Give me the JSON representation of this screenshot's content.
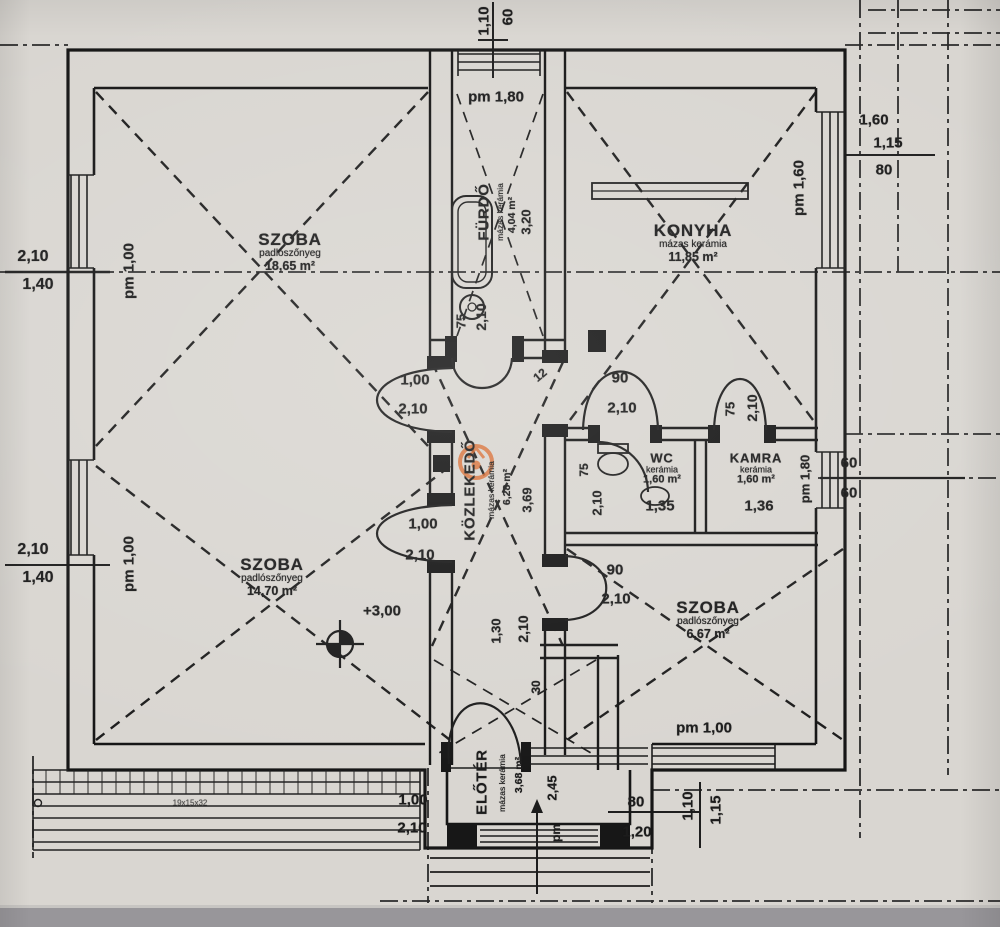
{
  "document": {
    "type": "floor-plan photo",
    "language": "hungarian"
  },
  "rooms": {
    "szoba1": {
      "name": "SZOBA",
      "floor": "padlószőnyeg",
      "area": "18,65 m²"
    },
    "konyha": {
      "name": "KONYHA",
      "floor": "mázas kerámia",
      "area": "11,85 m²"
    },
    "furdo": {
      "name": "FÜRDŐ",
      "floor": "mázas kerámia",
      "area": "4,04 m²",
      "width": "3,20"
    },
    "wc": {
      "name": "WC",
      "floor": "kerámia",
      "area": "1,60 m²",
      "width": "1,35"
    },
    "kamra": {
      "name": "KAMRA",
      "floor": "kerámia",
      "area": "1,60 m²",
      "width": "1,36"
    },
    "kozlekedo": {
      "name": "KÖZLEKEDŐ",
      "floor": "mázas kerámia",
      "area": "6,28 m²",
      "width": "3,69"
    },
    "szoba2": {
      "name": "SZOBA",
      "floor": "padlószőnyeg",
      "area": "14,70 m²"
    },
    "szoba3": {
      "name": "SZOBA",
      "floor": "padlószőnyeg",
      "area": "6,67 m²"
    },
    "eloter": {
      "name": "ELŐTÉR",
      "floor": "mázas kerámia",
      "area": "3,68 m²",
      "width": "2,45"
    }
  },
  "level_marker": {
    "value": "+3,00"
  },
  "watermark": {
    "color": "#d96a2e",
    "shape": "ring-logo"
  },
  "dims": [
    {
      "t": "1,10",
      "x": 484,
      "y": 21,
      "r": -90
    },
    {
      "t": "60",
      "x": 508,
      "y": 17,
      "r": -90
    },
    {
      "t": "pm 1,80",
      "x": 496,
      "y": 97
    },
    {
      "t": "1,60",
      "x": 874,
      "y": 120
    },
    {
      "t": "1,15",
      "x": 888,
      "y": 143
    },
    {
      "t": "80",
      "x": 884,
      "y": 170
    },
    {
      "t": "pm 1,60",
      "x": 799,
      "y": 188,
      "r": -90
    },
    {
      "t": "2,10",
      "x": 33,
      "y": 257,
      "s": 16
    },
    {
      "t": "1,40",
      "x": 38,
      "y": 285,
      "s": 16
    },
    {
      "t": "pm 1,00",
      "x": 129,
      "y": 271,
      "r": -90
    },
    {
      "t": "75",
      "x": 461,
      "y": 321,
      "r": -90,
      "s": 13
    },
    {
      "t": "2,10",
      "x": 481,
      "y": 317,
      "r": -90,
      "s": 14
    },
    {
      "t": "1,00",
      "x": 415,
      "y": 380
    },
    {
      "t": "2,10",
      "x": 413,
      "y": 409
    },
    {
      "t": "12",
      "x": 540,
      "y": 375,
      "r": -40,
      "s": 12
    },
    {
      "t": "90",
      "x": 620,
      "y": 378
    },
    {
      "t": "2,10",
      "x": 622,
      "y": 408
    },
    {
      "t": "75",
      "x": 730,
      "y": 409,
      "r": -90,
      "s": 13
    },
    {
      "t": "2,10",
      "x": 752,
      "y": 408,
      "r": -90,
      "s": 14
    },
    {
      "t": "pm 1,80",
      "x": 805,
      "y": 479,
      "r": -90,
      "s": 13
    },
    {
      "t": "60",
      "x": 849,
      "y": 463
    },
    {
      "t": "60",
      "x": 849,
      "y": 493
    },
    {
      "t": "75",
      "x": 584,
      "y": 470,
      "r": -90,
      "s": 12
    },
    {
      "t": "2,10",
      "x": 597,
      "y": 503,
      "r": -90,
      "s": 13
    },
    {
      "t": "1,35",
      "x": 660,
      "y": 506
    },
    {
      "t": "1,36",
      "x": 759,
      "y": 506
    },
    {
      "t": "2,10",
      "x": 33,
      "y": 550,
      "s": 16
    },
    {
      "t": "1,40",
      "x": 38,
      "y": 578,
      "s": 16
    },
    {
      "t": "pm 1,00",
      "x": 129,
      "y": 564,
      "r": -90
    },
    {
      "t": "1,00",
      "x": 423,
      "y": 524
    },
    {
      "t": "2,10",
      "x": 420,
      "y": 555
    },
    {
      "t": "90",
      "x": 615,
      "y": 570
    },
    {
      "t": "2,10",
      "x": 616,
      "y": 599
    },
    {
      "t": "1,30",
      "x": 496,
      "y": 631,
      "r": -90,
      "s": 13
    },
    {
      "t": "2,10",
      "x": 523,
      "y": 629,
      "r": -90,
      "s": 14
    },
    {
      "t": "30",
      "x": 536,
      "y": 687,
      "r": -90,
      "s": 12
    },
    {
      "t": "pm 1,00",
      "x": 704,
      "y": 728
    },
    {
      "t": "1,10",
      "x": 688,
      "y": 806,
      "r": -90
    },
    {
      "t": "1,15",
      "x": 716,
      "y": 810,
      "r": -90
    },
    {
      "t": "80",
      "x": 636,
      "y": 802
    },
    {
      "t": "1,20",
      "x": 637,
      "y": 832
    },
    {
      "t": "1,00",
      "x": 413,
      "y": 800
    },
    {
      "t": "2,10",
      "x": 412,
      "y": 828
    },
    {
      "t": "pm",
      "x": 556,
      "y": 833,
      "r": -90,
      "s": 12
    },
    {
      "t": "19x15x32",
      "x": 190,
      "y": 803,
      "s": 8,
      "light": true
    }
  ]
}
